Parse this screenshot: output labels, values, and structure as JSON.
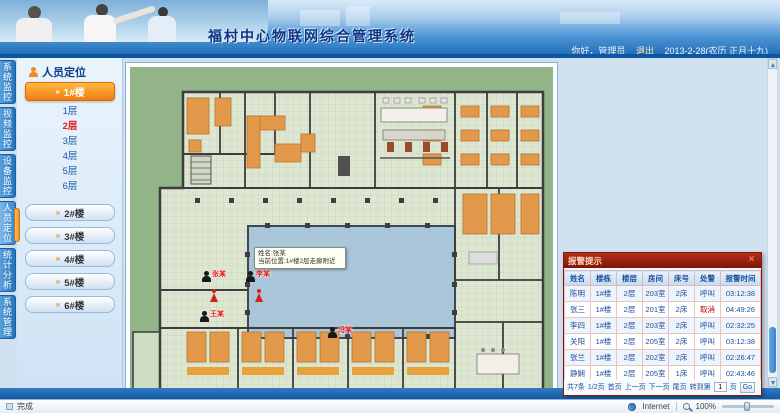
{
  "header": {
    "title": "福村中心物联网综合管理系统",
    "greeting": "你好，管理员",
    "logout": "退出",
    "date": "2013-2-28(农历 正月十九)"
  },
  "nav_tabs": [
    {
      "label": "系统监控",
      "active": false
    },
    {
      "label": "视频监控",
      "active": false
    },
    {
      "label": "设备监控",
      "active": false
    },
    {
      "label": "人员定位",
      "active": true
    },
    {
      "label": "统计分析",
      "active": false
    },
    {
      "label": "系统管理",
      "active": false
    }
  ],
  "sidebar": {
    "panel_title": "人员定位",
    "active_building": "1#楼",
    "arrow": "»",
    "floors": [
      {
        "label": "1层",
        "active": false
      },
      {
        "label": "2层",
        "active": true
      },
      {
        "label": "3层",
        "active": false
      },
      {
        "label": "4层",
        "active": false
      },
      {
        "label": "5层",
        "active": false
      },
      {
        "label": "6层",
        "active": false
      }
    ],
    "buildings": [
      "2#楼",
      "3#楼",
      "4#楼",
      "5#楼",
      "6#楼"
    ]
  },
  "floorplan": {
    "tooltip": {
      "line1": "姓名:张某",
      "line2": "当前位置:1#楼2层走廊附近"
    },
    "persons": [
      {
        "name": "张某",
        "x": 72,
        "y": 204,
        "figure": false
      },
      {
        "name": "李某",
        "x": 116,
        "y": 204,
        "figure": false
      },
      {
        "name": "",
        "x": 80,
        "y": 222,
        "figure": true
      },
      {
        "name": "",
        "x": 125,
        "y": 222,
        "figure": true
      },
      {
        "name": "王某",
        "x": 70,
        "y": 244,
        "figure": false
      },
      {
        "name": "冯某",
        "x": 198,
        "y": 260,
        "figure": false
      }
    ]
  },
  "alarm_panel": {
    "title": "报警提示",
    "close": "×",
    "columns": [
      "姓名",
      "楼栋",
      "楼层",
      "房间",
      "床号",
      "处警",
      "报警时间"
    ],
    "rows": [
      {
        "name": "陈明",
        "building": "1#楼",
        "floor": "2层",
        "room": "203室",
        "bed": "2床",
        "action": "呼叫",
        "cancel": false,
        "time": "03:12:38"
      },
      {
        "name": "张三",
        "building": "1#楼",
        "floor": "2层",
        "room": "201室",
        "bed": "2床",
        "action": "取消",
        "cancel": true,
        "time": "04:49:26"
      },
      {
        "name": "李四",
        "building": "1#楼",
        "floor": "2层",
        "room": "203室",
        "bed": "2床",
        "action": "呼叫",
        "cancel": false,
        "time": "02:32:25"
      },
      {
        "name": "关阳",
        "building": "1#楼",
        "floor": "2层",
        "room": "205室",
        "bed": "2床",
        "action": "呼叫",
        "cancel": false,
        "time": "03:12:38"
      },
      {
        "name": "张兰",
        "building": "1#楼",
        "floor": "2层",
        "room": "202室",
        "bed": "2床",
        "action": "呼叫",
        "cancel": false,
        "time": "02:26:47"
      },
      {
        "name": "静娴",
        "building": "1#楼",
        "floor": "2层",
        "room": "205室",
        "bed": "1床",
        "action": "呼叫",
        "cancel": false,
        "time": "02:43:46"
      }
    ],
    "pagination": {
      "total": "共7条",
      "page": "1/2页",
      "first": "首页",
      "prev": "上一页",
      "next": "下一页",
      "last": "尾页",
      "goto_prefix": "转到第",
      "goto_suffix": "页",
      "goto_value": "1",
      "go": "Go"
    }
  },
  "statusbar": {
    "left": "完成",
    "zone": "Internet",
    "zoom": "100%"
  }
}
